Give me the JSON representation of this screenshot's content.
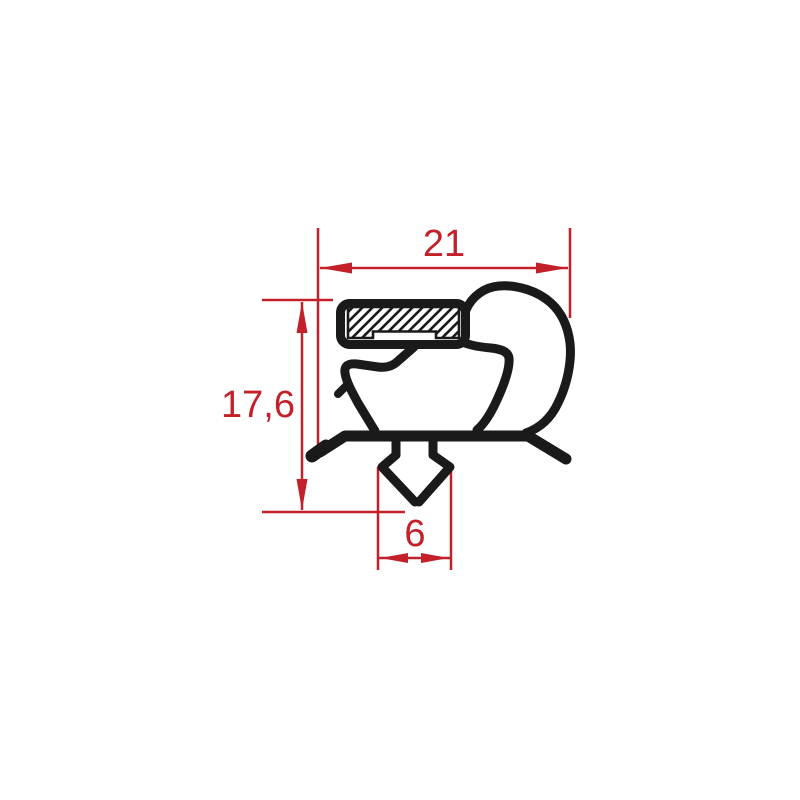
{
  "drawing": {
    "title": "Gasket profile cross-section technical drawing",
    "kind": "dimensioned 2D profile drawing",
    "background_color": "#ffffff",
    "profile_color": "#1a1a1a",
    "dimension_color": "#c3202a",
    "dimensions": {
      "top_width": {
        "label": "21",
        "orientation": "horizontal",
        "position": "top"
      },
      "left_height": {
        "label": "17,6",
        "orientation": "vertical",
        "position": "left"
      },
      "bottom_width": {
        "label": "6",
        "orientation": "horizontal",
        "position": "bottom"
      }
    },
    "features": [
      "magnet-pocket-with-hatching",
      "right-balloon-bulb",
      "inner-lip",
      "base-web",
      "left-foot-flap",
      "right-foot-flap",
      "bottom-anchor-barb"
    ]
  }
}
